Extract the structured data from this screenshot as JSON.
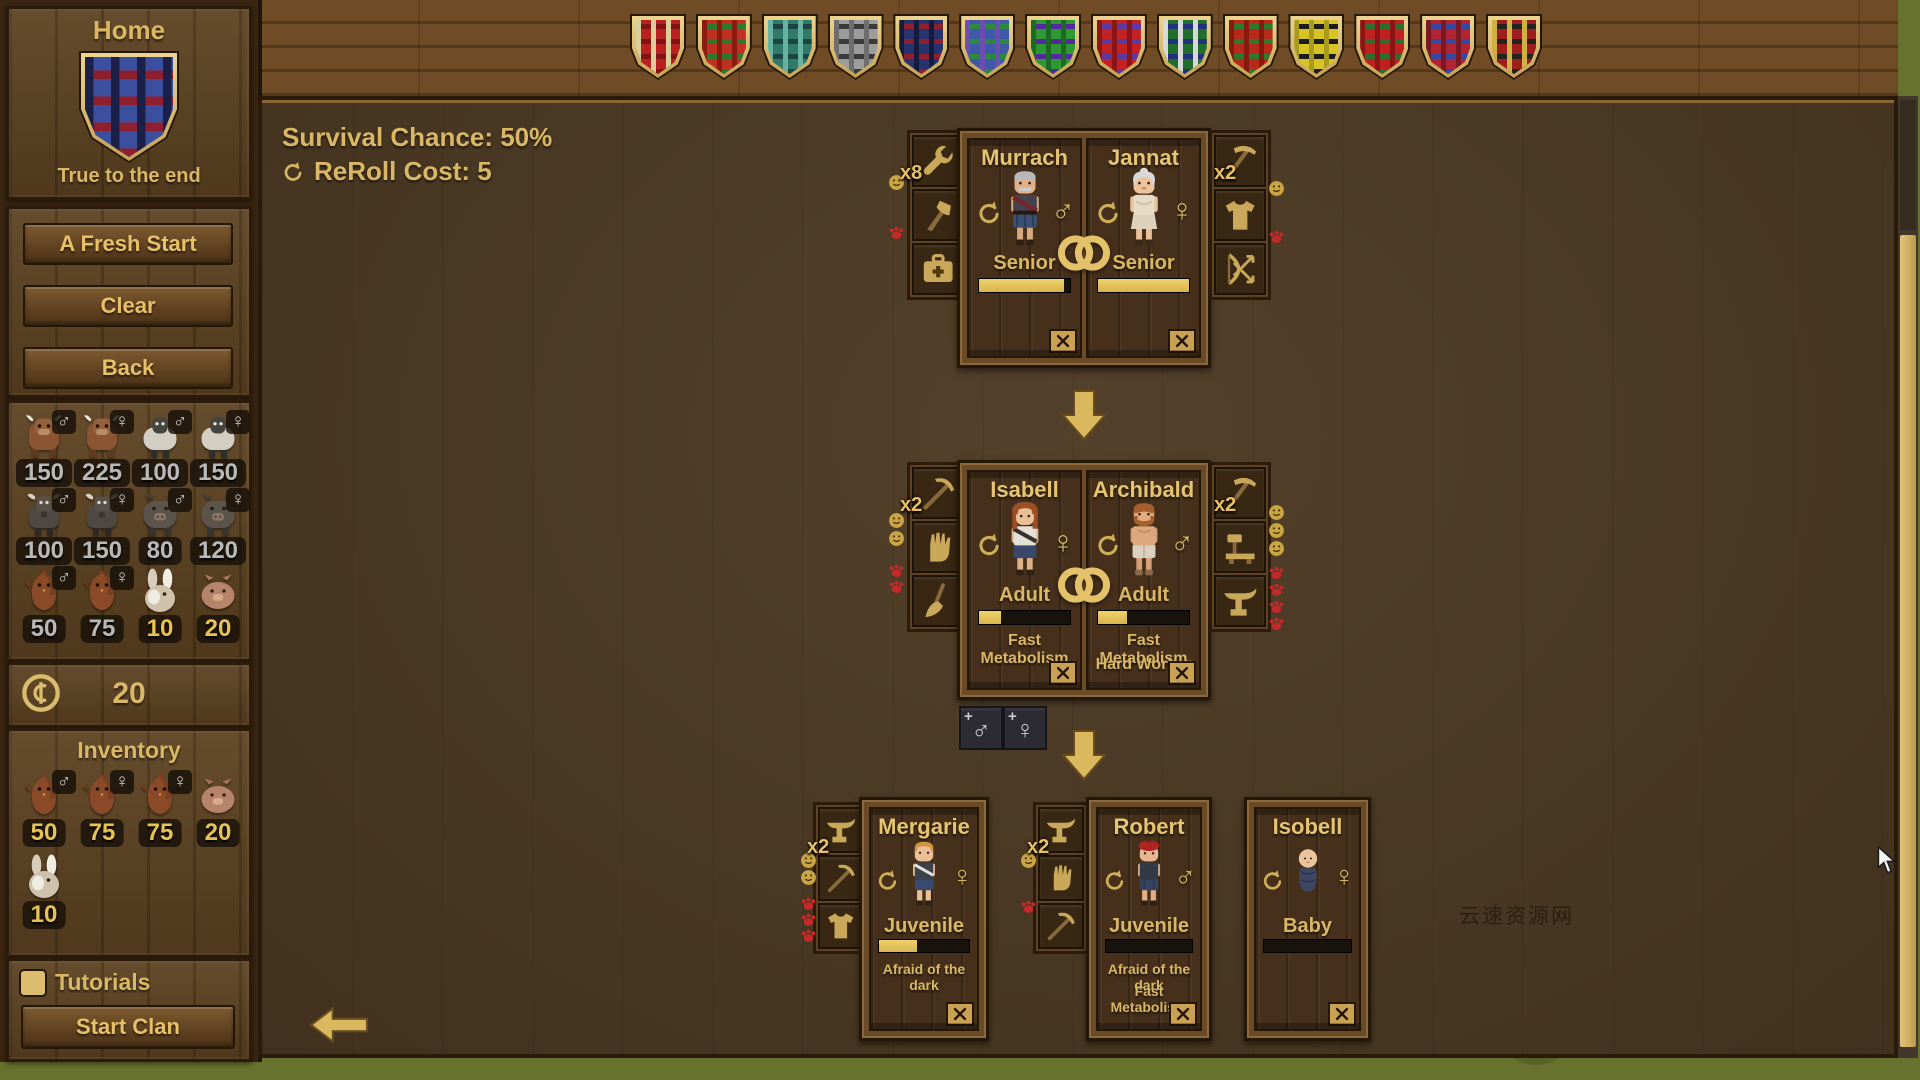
{
  "symbols": {
    "male": "♂",
    "female": "♀"
  },
  "sidebar": {
    "home_title": "Home",
    "clan_motto": "True to the end",
    "clan_shield": {
      "base": "#3b4f9e",
      "h": "#8e1f2e",
      "v": "#1a2048"
    },
    "buttons": {
      "fresh_start": "A Fresh Start",
      "clear": "Clear",
      "back": "Back"
    },
    "market_animals": [
      {
        "species": "cow",
        "sex_symbol": "♂",
        "value": "150"
      },
      {
        "species": "cow",
        "sex_symbol": "♀",
        "value": "225"
      },
      {
        "species": "sheep",
        "sex_symbol": "♂",
        "value": "100"
      },
      {
        "species": "sheep",
        "sex_symbol": "♀",
        "value": "150"
      },
      {
        "species": "goat",
        "sex_symbol": "♂",
        "value": "100"
      },
      {
        "species": "goat",
        "sex_symbol": "♀",
        "value": "150"
      },
      {
        "species": "pig",
        "sex_symbol": "♂",
        "value": "80"
      },
      {
        "species": "pig",
        "sex_symbol": "♀",
        "value": "120"
      },
      {
        "species": "chicken",
        "sex_symbol": "♂",
        "value": "50"
      },
      {
        "species": "chicken",
        "sex_symbol": "♀",
        "value": "75"
      },
      {
        "species": "rabbit",
        "sex_symbol": "",
        "value": "10"
      },
      {
        "species": "piglet",
        "sex_symbol": "",
        "value": "20"
      }
    ],
    "coins": "20",
    "inventory_title": "Inventory",
    "inventory_items": [
      {
        "species": "chicken",
        "sex_symbol": "♂",
        "value": "50"
      },
      {
        "species": "chicken",
        "sex_symbol": "♀",
        "value": "75"
      },
      {
        "species": "chicken",
        "sex_symbol": "♀",
        "value": "75"
      },
      {
        "species": "piglet",
        "sex_symbol": "",
        "value": "20"
      },
      {
        "species": "rabbit",
        "sex_symbol": "",
        "value": "10"
      }
    ],
    "tutorials_label": "Tutorials",
    "start_clan_label": "Start Clan"
  },
  "top_bar": {
    "shields": [
      {
        "base": "#b92020",
        "h": "#801313",
        "v": "#d9cf9a"
      },
      {
        "base": "#bf3020",
        "h": "#2e7a2c",
        "v": "#8c1b12"
      },
      {
        "base": "#2f7a68",
        "h": "#1c4440",
        "v": "#67b3a0"
      },
      {
        "base": "#9c9c9c",
        "h": "#3a3a3a",
        "v": "#6e6e6e"
      },
      {
        "base": "#27336e",
        "h": "#8e1f2e",
        "v": "#141c3e"
      },
      {
        "base": "#3f58a8",
        "h": "#2c8a3e",
        "v": "#6a4fb0"
      },
      {
        "base": "#2e9932",
        "h": "#5527a0",
        "v": "#1d6b22"
      },
      {
        "base": "#c42222",
        "h": "#5a3aa0",
        "v": "#8c1616"
      },
      {
        "base": "#1f6e2c",
        "h": "#23307e",
        "v": "#d8d8d8"
      },
      {
        "base": "#b8291a",
        "h": "#2d7a2d",
        "v": "#871a10"
      },
      {
        "base": "#d8c325",
        "h": "#1c1c1c",
        "v": "#a89a1a"
      },
      {
        "base": "#c02020",
        "h": "#2d6e2d",
        "v": "#8c1414"
      },
      {
        "base": "#b02433",
        "h": "#35479e",
        "v": "#7c1824"
      },
      {
        "base": "#9e1d1d",
        "h": "#23231f",
        "v": "#d0b040"
      }
    ]
  },
  "main": {
    "survival_chance": "Survival Chance: 50%",
    "reroll_cost": "ReRoll Cost: 5",
    "watermark": "云速资源网",
    "add_child_plus": "+",
    "generation1": {
      "left_tools": {
        "multiplier": "x8",
        "tools": [
          "wrench",
          "axe",
          "medkit"
        ]
      },
      "right_tools": {
        "multiplier": "x2",
        "tools": [
          "scythe",
          "shirt",
          "bow"
        ]
      },
      "characters": [
        {
          "name": "Murrach",
          "sex_symbol": "♂",
          "age_stage": "Senior",
          "life_pct": 93,
          "traits": []
        },
        {
          "name": "Jannat",
          "sex_symbol": "♀",
          "age_stage": "Senior",
          "life_pct": 100,
          "traits": []
        }
      ]
    },
    "generation2": {
      "left_tools": {
        "multiplier": "x2",
        "tools": [
          "pick",
          "hand",
          "broom"
        ]
      },
      "right_tools": {
        "multiplier": "x2",
        "tools": [
          "scythe",
          "bench",
          "anvil"
        ]
      },
      "characters": [
        {
          "name": "Isabell",
          "sex_symbol": "♀",
          "age_stage": "Adult",
          "life_pct": 24,
          "traits": [
            "Fast Metabolism"
          ]
        },
        {
          "name": "Archibald",
          "sex_symbol": "♂",
          "age_stage": "Adult",
          "life_pct": 32,
          "traits": [
            "Fast Metabolism",
            "Hard Worker"
          ]
        }
      ]
    },
    "generation3": [
      {
        "name": "Mergarie",
        "sex_symbol": "♀",
        "age_stage": "Juvenile",
        "life_pct": 42,
        "traits": [
          "Afraid of the dark"
        ],
        "tools": {
          "multiplier": "x2",
          "list": [
            "anvil",
            "pick",
            "shirt"
          ]
        }
      },
      {
        "name": "Robert",
        "sex_symbol": "♂",
        "age_stage": "Juvenile",
        "life_pct": 0,
        "traits": [
          "Afraid of the dark",
          "Fast Metabolism"
        ],
        "tools": {
          "multiplier": "x2",
          "list": [
            "anvil",
            "hand",
            "pick"
          ]
        }
      },
      {
        "name": "Isobell",
        "sex_symbol": "♀",
        "age_stage": "Baby",
        "life_pct": 0,
        "traits": []
      }
    ]
  }
}
